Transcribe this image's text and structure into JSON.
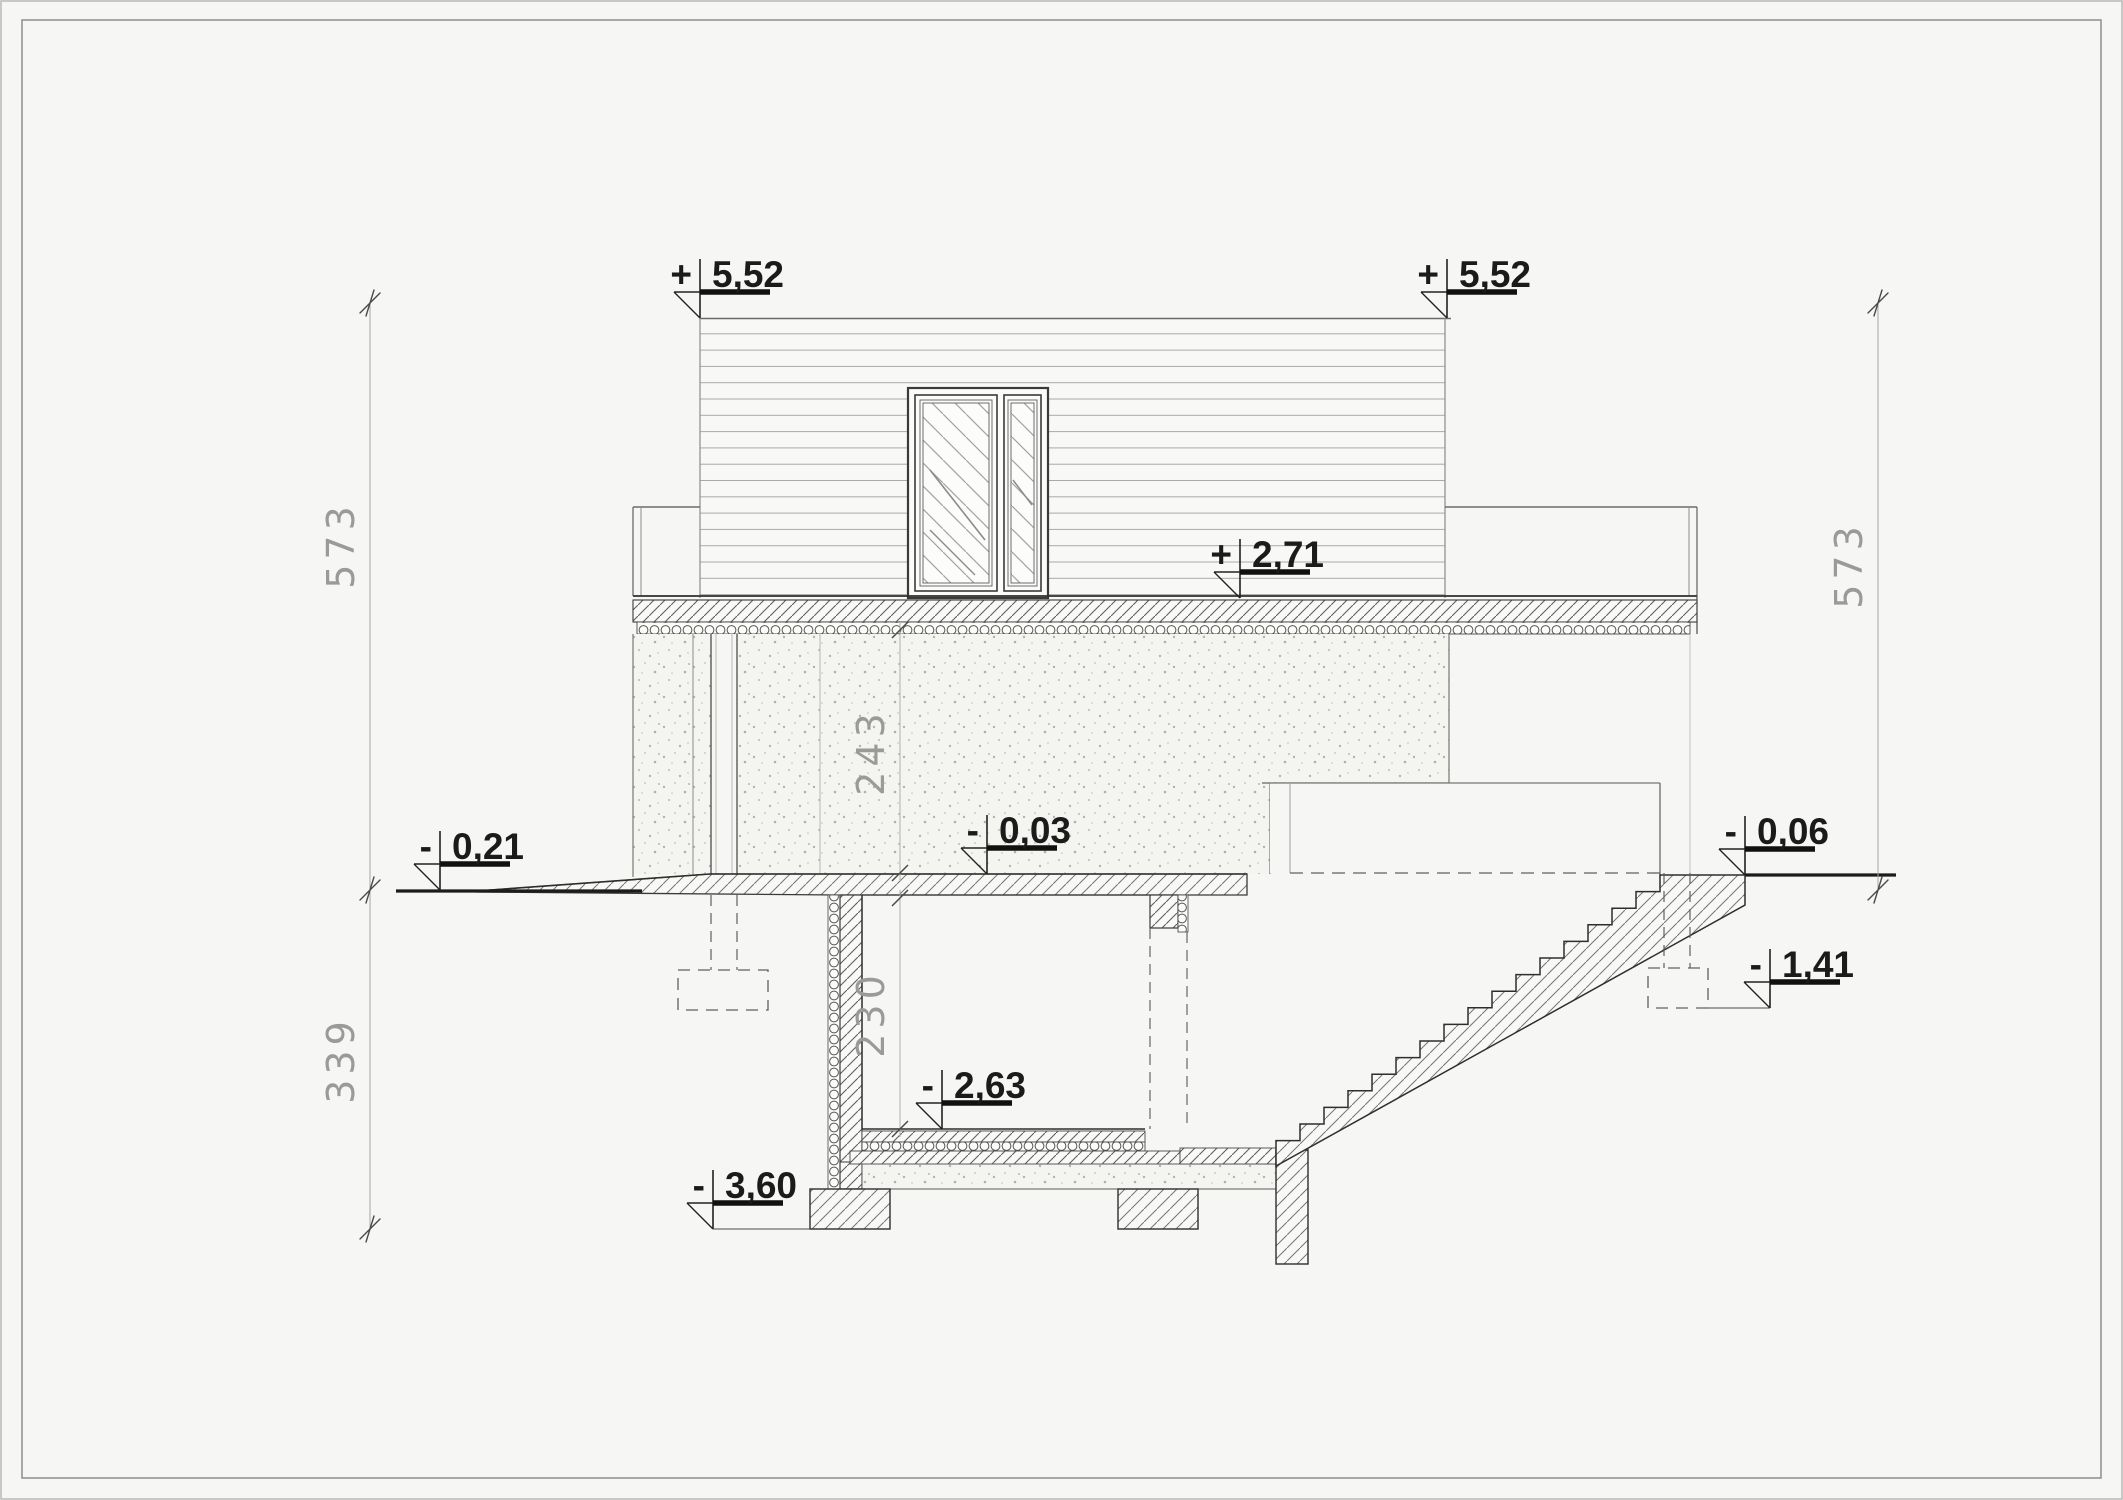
{
  "drawing": {
    "kind": "architectural cross-section",
    "scale_hint": "1 px = 1 cm",
    "levels": [
      {
        "id": "roof-edge-left",
        "sign": "+",
        "value": "5,52"
      },
      {
        "id": "roof-edge-right",
        "sign": "+",
        "value": "5,52"
      },
      {
        "id": "upper-floor-level",
        "sign": "+",
        "value": "2,71"
      },
      {
        "id": "terrain-left",
        "sign": "-",
        "value": "0,21"
      },
      {
        "id": "ground-floor-level",
        "sign": "-",
        "value": "0,03"
      },
      {
        "id": "terrain-right",
        "sign": "-",
        "value": "0,06"
      },
      {
        "id": "stair-footing-level",
        "sign": "-",
        "value": "1,41"
      },
      {
        "id": "basement-floor-level",
        "sign": "-",
        "value": "2,63"
      },
      {
        "id": "foundation-level",
        "sign": "-",
        "value": "3,60"
      }
    ],
    "dimensions": [
      {
        "id": "overall-height-left",
        "value": "573"
      },
      {
        "id": "foundation-depth-left",
        "value": "339"
      },
      {
        "id": "overall-height-right",
        "value": "573"
      },
      {
        "id": "ground-floor-clear-height",
        "value": "243"
      },
      {
        "id": "basement-clear-height",
        "value": "230"
      }
    ]
  }
}
